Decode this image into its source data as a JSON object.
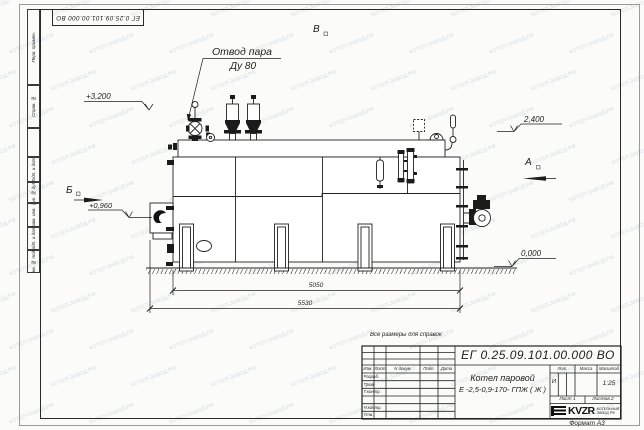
{
  "watermark": {
    "text": "КОТЕЛ-ЗАВОД.РФ"
  },
  "corner_stamp": "ЕГ 0.25.09.101.00.000  ВО",
  "margin_labels": {
    "perv": "Перв. примен.",
    "sprav": "Справ. №",
    "podp1": "Подп. и дата",
    "inv_dubl": "Инв. № дубл.",
    "vzam": "Взам. инв. №",
    "podp2": "Подп. и дата",
    "inv_podl": "Инв. № подл."
  },
  "annotations": {
    "steam_outlet_line1": "Отвод пара",
    "steam_outlet_line2": "Ду 80",
    "elev_top": "+3,200",
    "elev_drum": "2,400",
    "elev_burner": "+0,960",
    "elev_ground": "0,000",
    "view_b": "Б",
    "view_v": "В",
    "view_a": "А",
    "dim_inner": "5050",
    "dim_outer": "5530"
  },
  "titleblock": {
    "note": "Все размеры для справок",
    "doc_number": "ЕГ 0.25.09.101.00.000  ВО",
    "product_name_line1": "Котел паровой",
    "product_name_line2": "Е -2,5-0,9-170- ГПЖ ( Ж )",
    "header_cells": [
      "Изм.",
      "Лист",
      "N докум.",
      "Подп.",
      "Дата"
    ],
    "rows": [
      "Разраб.",
      "Пров.",
      "Т.контр.",
      "",
      "Н.контр.",
      "Утв."
    ],
    "lit_label": "Лит.",
    "mass_label": "Масса",
    "scale_label": "Масштаб",
    "lit_value": "И",
    "scale_value": "1:25",
    "sheet_label": "Лист 1",
    "sheets_label": "Листов 2",
    "logo_text": "KVZR",
    "org_line1": "КОТЕЛЬНЫЙ",
    "org_line2": "ЗАВОД РФ",
    "format_label": "Формат А3"
  }
}
